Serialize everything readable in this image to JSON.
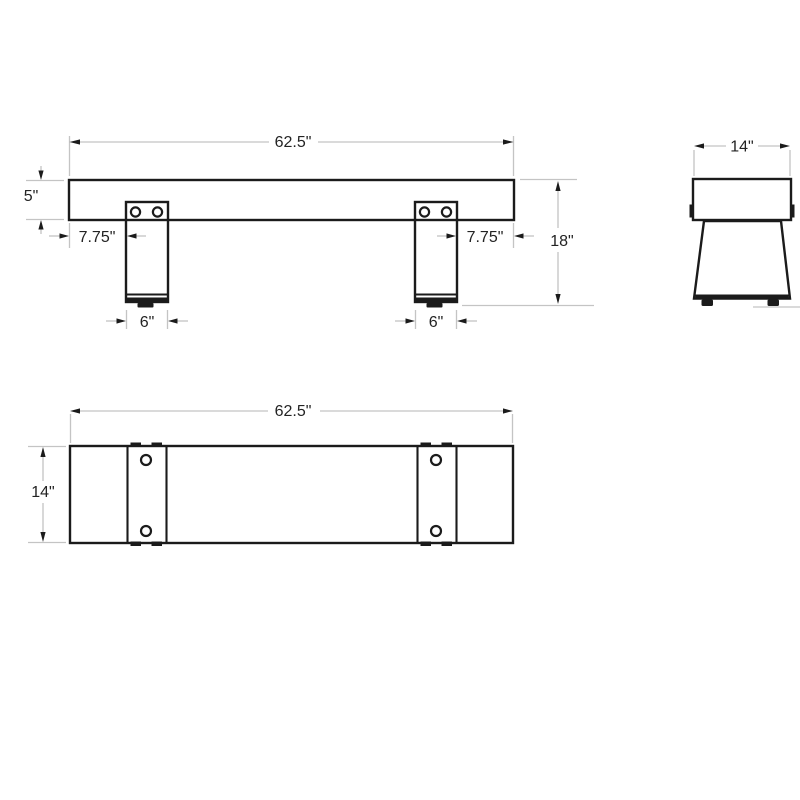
{
  "drawing": {
    "type": "bench-dimension-diagram",
    "views": {
      "front": {
        "name": "front-view",
        "overall_width": "62.5\"",
        "seat_thickness": "5\"",
        "leg_inset_left": "7.75\"",
        "leg_inset_right": "7.75\"",
        "overall_height": "18\"",
        "leg_width_left": "6\"",
        "leg_width_right": "6\""
      },
      "side": {
        "name": "side-view",
        "overall_depth": "14\""
      },
      "top": {
        "name": "top-view",
        "overall_width": "62.5\"",
        "overall_depth": "14\""
      }
    },
    "colors": {
      "object_line": "#1b1b1b",
      "dimension_line": "#c4c4c4",
      "text": "#232323",
      "background": "#ffffff"
    }
  }
}
